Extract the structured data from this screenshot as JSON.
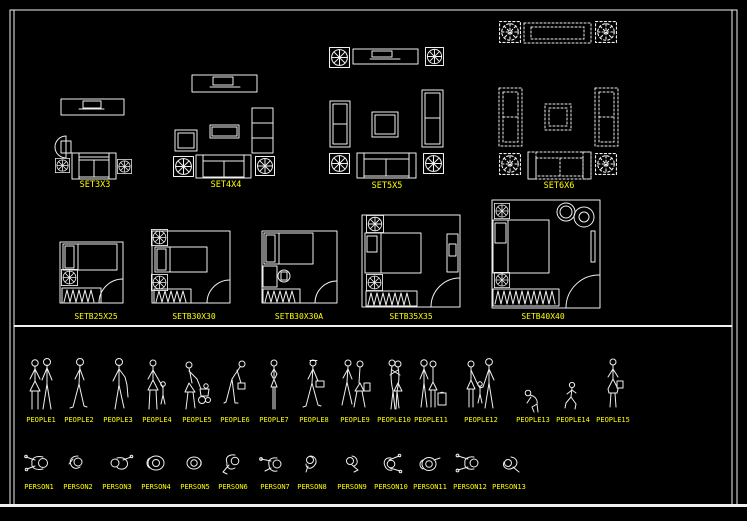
{
  "canvas": {
    "background": "#000000",
    "line_color": "#f0f0f0",
    "label_color": "#ffff00"
  },
  "sections": {
    "sofa_sets": {
      "items": [
        {
          "label": "SET3X3",
          "icon": "sofa-set-3x3-drawing"
        },
        {
          "label": "SET4X4",
          "icon": "sofa-set-4x4-drawing"
        },
        {
          "label": "SET5X5",
          "icon": "sofa-set-5x5-drawing"
        },
        {
          "label": "SET6X6",
          "icon": "sofa-set-6x6-drawing"
        }
      ]
    },
    "bedroom_sets": {
      "items": [
        {
          "label": "SETB25X25",
          "icon": "bedroom-set-25x25-drawing"
        },
        {
          "label": "SETB30X30",
          "icon": "bedroom-set-30x30-drawing"
        },
        {
          "label": "SETB30X30A",
          "icon": "bedroom-set-30x30a-drawing"
        },
        {
          "label": "SETB35X35",
          "icon": "bedroom-set-35x35-drawing"
        },
        {
          "label": "SETB40X40",
          "icon": "bedroom-set-40x40-drawing"
        }
      ]
    },
    "people_elevations": {
      "items": [
        {
          "label": "PEOPLE1",
          "icon": "couple-standing-figure"
        },
        {
          "label": "PEOPLE2",
          "icon": "man-walking-figure"
        },
        {
          "label": "PEOPLE3",
          "icon": "man-standing-figure"
        },
        {
          "label": "PEOPLE4",
          "icon": "woman-with-child-figure"
        },
        {
          "label": "PEOPLE5",
          "icon": "woman-with-stroller-figure"
        },
        {
          "label": "PEOPLE6",
          "icon": "man-bending-with-bag-figure"
        },
        {
          "label": "PEOPLE7",
          "icon": "woman-standing-figure"
        },
        {
          "label": "PEOPLE8",
          "icon": "man-with-briefcase-figure"
        },
        {
          "label": "PEOPLE9",
          "icon": "couple-walking-figure"
        },
        {
          "label": "PEOPLE10",
          "icon": "couple-embracing-figure"
        },
        {
          "label": "PEOPLE11",
          "icon": "couple-with-luggage-figure"
        },
        {
          "label": "PEOPLE12",
          "icon": "family-with-child-figure"
        },
        {
          "label": "PEOPLE13",
          "icon": "child-crouching-figure"
        },
        {
          "label": "PEOPLE14",
          "icon": "child-running-figure"
        },
        {
          "label": "PEOPLE15",
          "icon": "woman-with-bag-figure"
        }
      ]
    },
    "person_plan_views": {
      "items": [
        {
          "label": "PERSON1",
          "icon": "person-plan-reaching"
        },
        {
          "label": "PERSON2",
          "icon": "person-plan-seated"
        },
        {
          "label": "PERSON3",
          "icon": "person-plan-arm-out"
        },
        {
          "label": "PERSON4",
          "icon": "person-plan-top-round"
        },
        {
          "label": "PERSON5",
          "icon": "person-plan-top-round-small"
        },
        {
          "label": "PERSON6",
          "icon": "person-plan-arm-bent"
        },
        {
          "label": "PERSON7",
          "icon": "person-plan-pointing"
        },
        {
          "label": "PERSON8",
          "icon": "person-plan-curled"
        },
        {
          "label": "PERSON9",
          "icon": "person-plan-turning"
        },
        {
          "label": "PERSON10",
          "icon": "person-plan-arms-forward"
        },
        {
          "label": "PERSON11",
          "icon": "person-plan-round-arm"
        },
        {
          "label": "PERSON12",
          "icon": "person-plan-arms-spread"
        },
        {
          "label": "PERSON13",
          "icon": "person-plan-lying"
        }
      ]
    }
  }
}
